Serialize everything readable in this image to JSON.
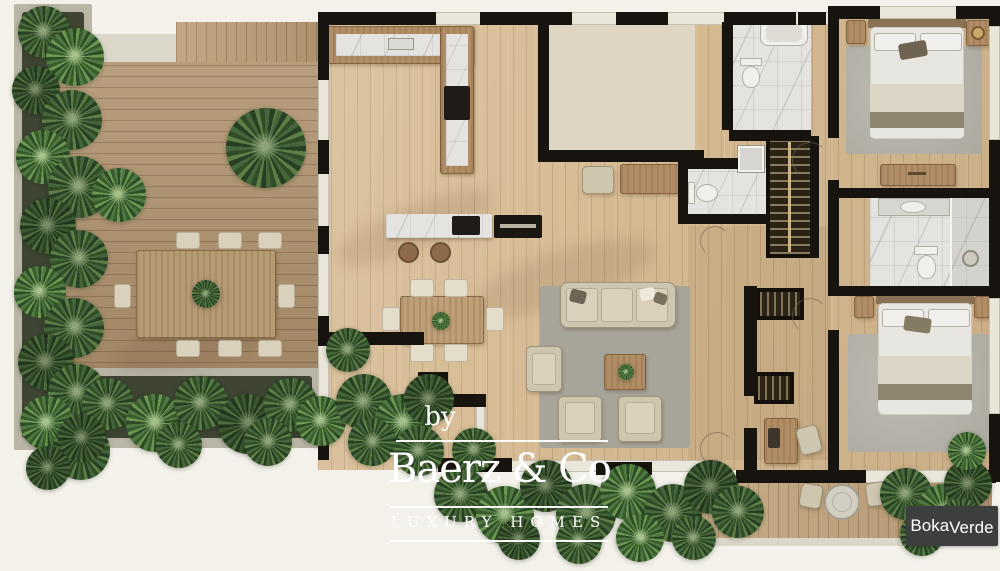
{
  "watermark": {
    "prefix": "by",
    "brand": "Baerz & Co",
    "tagline": "LUXURY HOMES"
  },
  "developer_badge": {
    "name_part1": "Boka",
    "name_part2": "Verde"
  },
  "palette": {
    "background": "#f3f1ea",
    "walls": "#17130e",
    "interior_wood": "#d6ba92",
    "terrace_deck_wood": "#b29672",
    "small_terrace_wood": "#c3a67e",
    "marble": "#e4e3e0",
    "void_panel": "#ded5c2",
    "rug_living": "#a7a499",
    "rug_bedroom": "#b6b3a9",
    "upholstery": "#cfc6b0",
    "wood_furniture": "#b08d64",
    "foliage_dark": "#273f22",
    "foliage_light": "#5d7f47",
    "planter_curb": "#bab6a6",
    "planter_soil": "#3f4433",
    "badge_background": "#3c3f3e",
    "watermark_text": "#ffffff"
  }
}
